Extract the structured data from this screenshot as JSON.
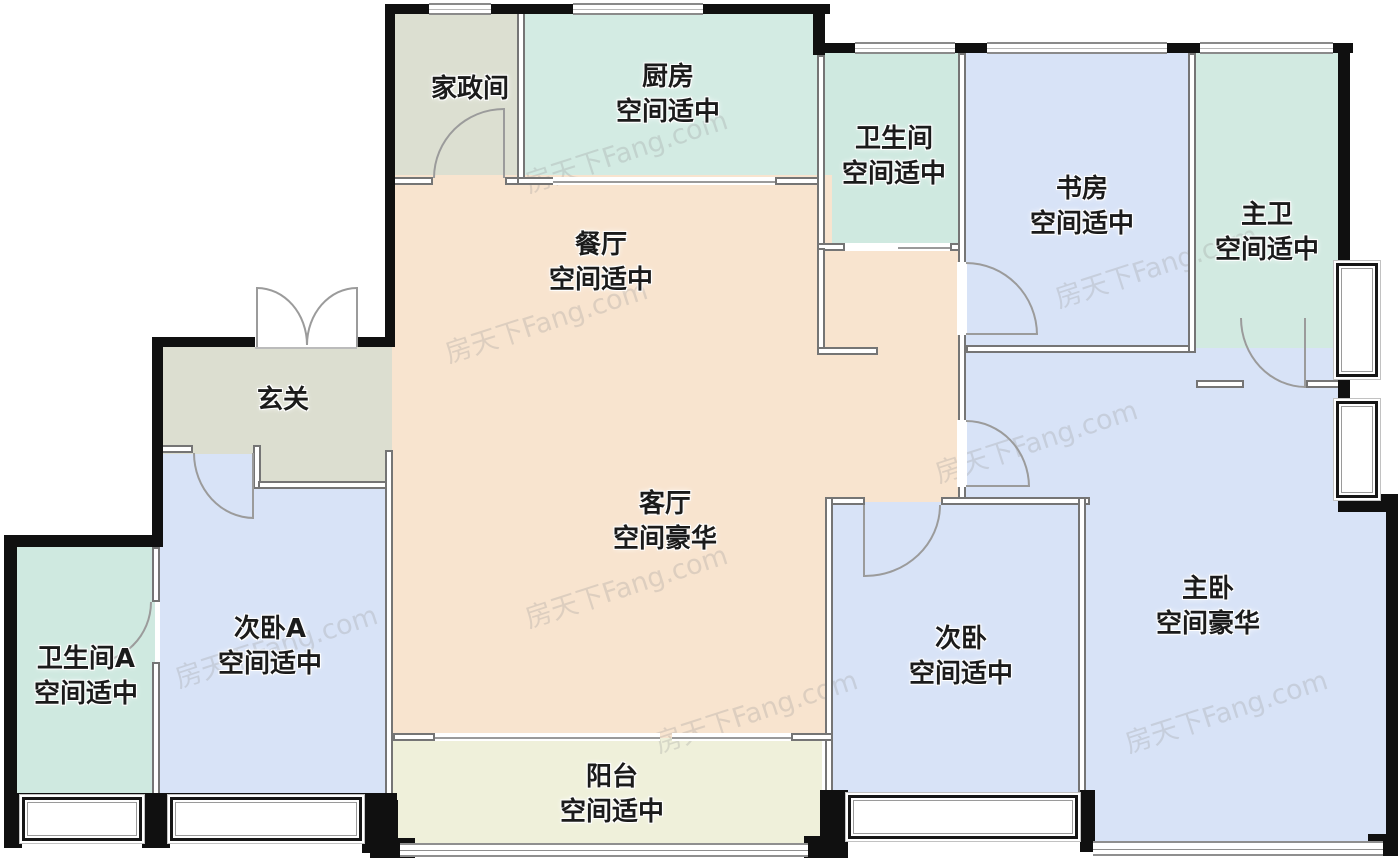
{
  "watermark": {
    "text": "房天下Fang.com"
  },
  "colors": {
    "wall": "#101010",
    "interior_wall": "#757575",
    "room_gray": "#dcded0",
    "room_teal": "#d2eae2",
    "room_blue": "#d8e3f7",
    "room_peach": "#f8e4cf",
    "room_balcony": "#eff0da"
  },
  "rooms": [
    {
      "id": "housekeeping",
      "name": "家政间",
      "grade": ""
    },
    {
      "id": "kitchen",
      "name": "厨房",
      "grade": "空间适中"
    },
    {
      "id": "bathroom",
      "name": "卫生间",
      "grade": "空间适中"
    },
    {
      "id": "study",
      "name": "书房",
      "grade": "空间适中"
    },
    {
      "id": "master-bathroom",
      "name": "主卫",
      "grade": "空间适中"
    },
    {
      "id": "dining-room",
      "name": "餐厅",
      "grade": "空间适中"
    },
    {
      "id": "entryway",
      "name": "玄关",
      "grade": ""
    },
    {
      "id": "living-room",
      "name": "客厅",
      "grade": "空间豪华"
    },
    {
      "id": "bedroom-a",
      "name": "次卧A",
      "grade": "空间适中"
    },
    {
      "id": "bathroom-a",
      "name": "卫生间A",
      "grade": "空间适中"
    },
    {
      "id": "bedroom-2",
      "name": "次卧",
      "grade": "空间适中"
    },
    {
      "id": "master-bedroom",
      "name": "主卧",
      "grade": "空间豪华"
    },
    {
      "id": "balcony",
      "name": "阳台",
      "grade": "空间适中"
    }
  ]
}
